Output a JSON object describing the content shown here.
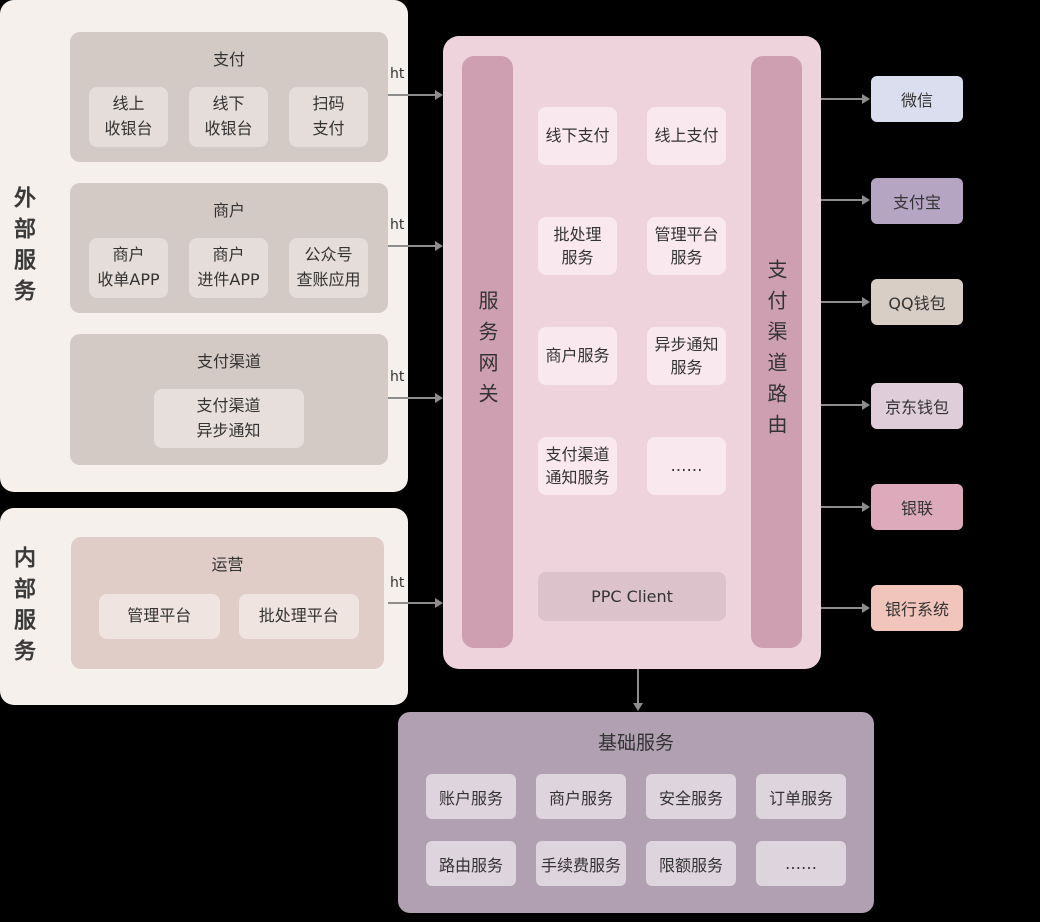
{
  "external": {
    "label": "外部服务",
    "groups": [
      {
        "title": "支付",
        "boxes": [
          "线上\n收银台",
          "线下\n收银台",
          "扫码\n支付"
        ]
      },
      {
        "title": "商户",
        "boxes": [
          "商户\n收单APP",
          "商户\n进件APP",
          "公众号\n查账应用"
        ]
      },
      {
        "title": "支付渠道",
        "boxes": [
          "支付渠道\n异步通知"
        ]
      }
    ]
  },
  "internal": {
    "label": "内部服务",
    "groups": [
      {
        "title": "运营",
        "boxes": [
          "管理平台",
          "批处理平台"
        ]
      }
    ]
  },
  "connectors": {
    "http_label": "ht"
  },
  "core": {
    "gateway_label": "服务网关",
    "router_label": "支付渠道路由",
    "services": [
      "线下支付",
      "线上支付",
      "批处理\n服务",
      "管理平台\n服务",
      "商户服务",
      "异步通知\n服务",
      "支付渠道\n通知服务",
      "……"
    ],
    "client_label": "PPC Client"
  },
  "channels": [
    {
      "label": "微信",
      "color": "#dbdeee"
    },
    {
      "label": "支付宝",
      "color": "#b5a4c2"
    },
    {
      "label": "QQ钱包",
      "color": "#d8cec5"
    },
    {
      "label": "京东钱包",
      "color": "#dfcdd9"
    },
    {
      "label": "银联",
      "color": "#dcaaba"
    },
    {
      "label": "银行系统",
      "color": "#f2c5bc"
    }
  ],
  "foundation": {
    "title": "基础服务",
    "boxes": [
      "账户服务",
      "商户服务",
      "安全服务",
      "订单服务",
      "路由服务",
      "手续费服务",
      "限额服务",
      "……"
    ]
  }
}
